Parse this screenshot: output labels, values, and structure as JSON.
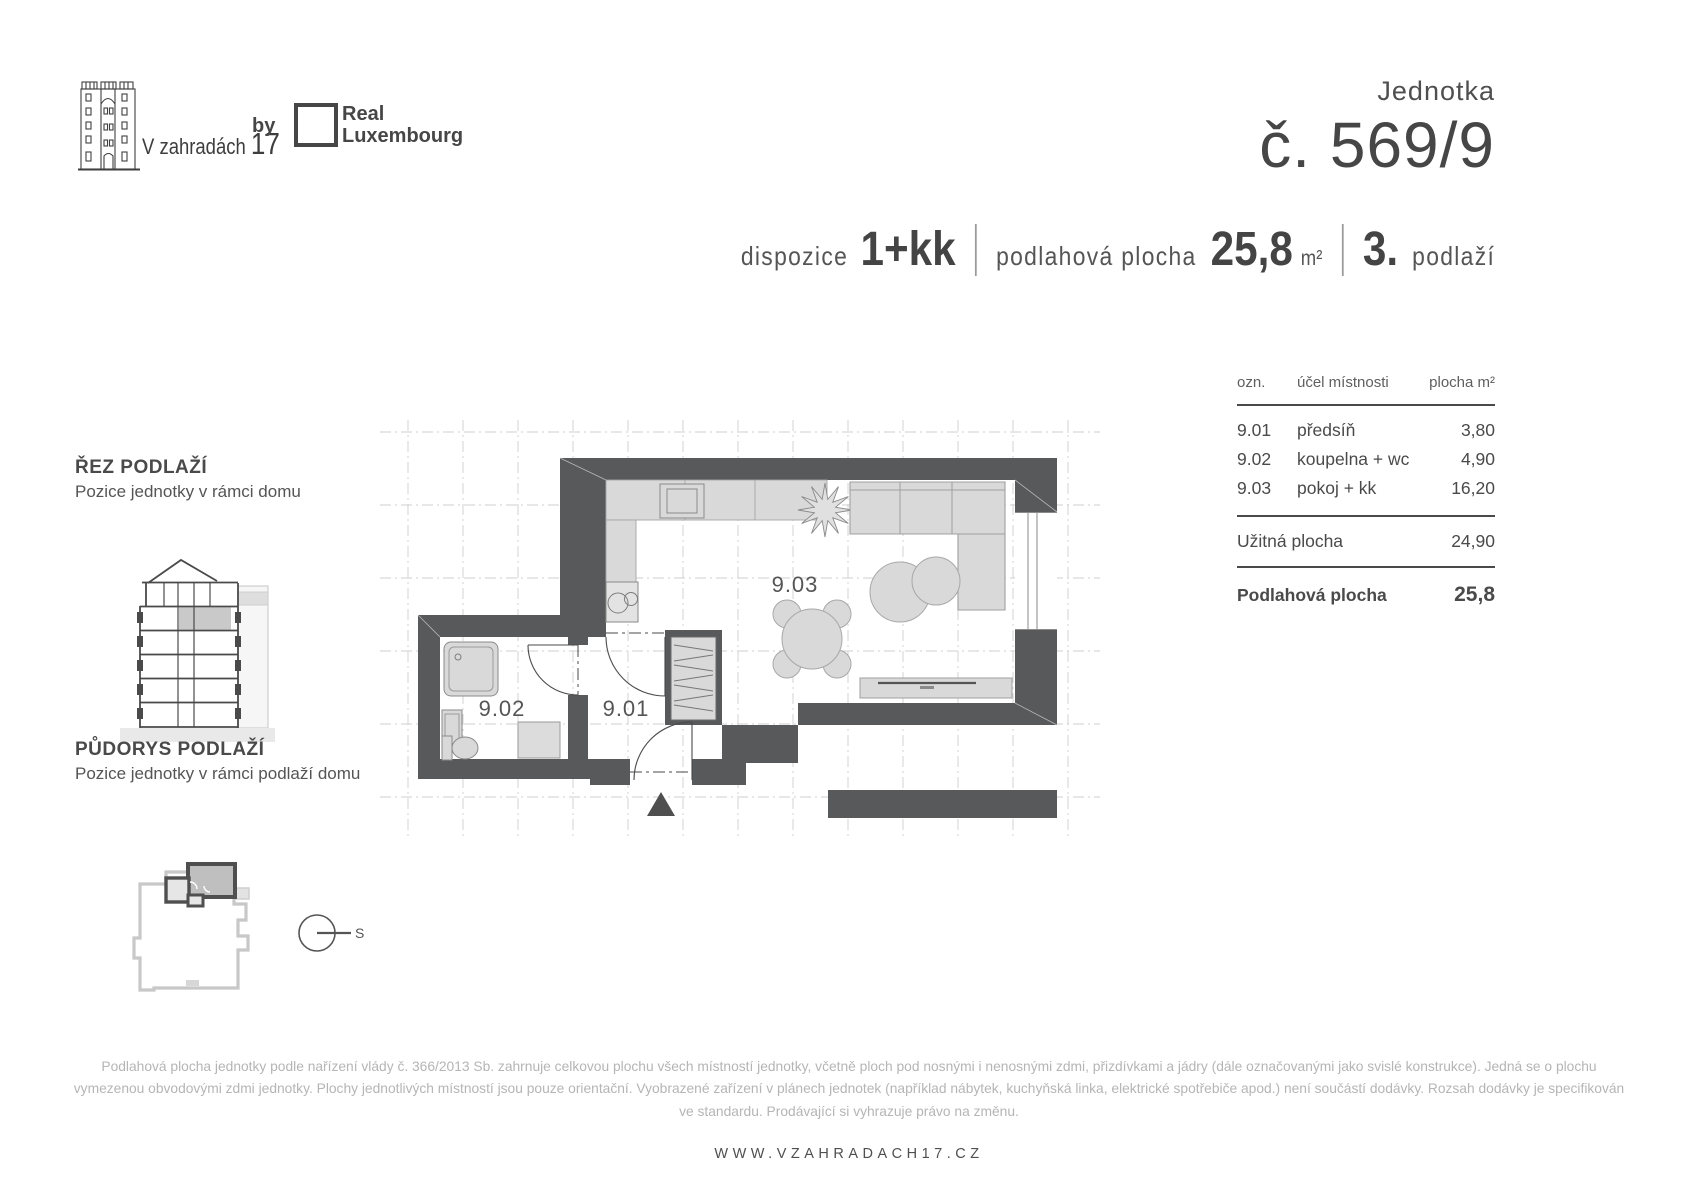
{
  "header": {
    "logo_text": "V zahradách ",
    "logo_number": "17",
    "by_label": "by",
    "brand_line1": "Real",
    "brand_line2": "Luxembourg",
    "unit_label": "Jednotka",
    "unit_number": "č. 569/9"
  },
  "specs": {
    "dispozice_label": "dispozice",
    "dispozice_value": "1+kk",
    "area_label": "podlahová plocha",
    "area_value": "25,8",
    "area_unit": "m²",
    "floor_value": "3.",
    "floor_label": "podlaží"
  },
  "section_cut": {
    "title": "ŘEZ PODLAŽÍ",
    "subtitle": "Pozice jednotky v rámci domu"
  },
  "floor_position": {
    "title": "PŮDORYS PODLAŽÍ",
    "subtitle": "Pozice jednotky v rámci podlaží domu"
  },
  "compass_label": "S",
  "plan": {
    "rooms": [
      {
        "id": "9.01"
      },
      {
        "id": "9.02"
      },
      {
        "id": "9.03"
      }
    ]
  },
  "table": {
    "headers": {
      "ozn": "ozn.",
      "ucel": "účel místnosti",
      "plocha": "plocha m²"
    },
    "rows": [
      {
        "ozn": "9.01",
        "ucel": "předsíň",
        "plocha": "3,80"
      },
      {
        "ozn": "9.02",
        "ucel": "koupelna + wc",
        "plocha": "4,90"
      },
      {
        "ozn": "9.03",
        "ucel": "pokoj + kk",
        "plocha": "16,20"
      }
    ],
    "usable_label": "Užitná plocha",
    "usable_value": "24,90",
    "total_label": "Podlahová plocha",
    "total_value": "25,8"
  },
  "footer": {
    "disclaimer": "Podlahová plocha jednotky podle nařízení vlády č. 366/2013 Sb. zahrnuje celkovou plochu všech místností jednotky, včetně ploch pod nosnými i nenosnými zdmi, přizdívkami a jádry (dále označovanými jako svislé konstrukce). Jedná se o plochu vymezenou obvodovými zdmi jednotky. Plochy jednotlivých místností jsou pouze orientační. Vyobrazené zařízení v plánech jednotek (například nábytek, kuchyňská linka, elektrické spotřebiče apod.) není součástí dodávky. Rozsah dodávky je specifikován ve standardu. Prodávající si vyhrazuje právo na změnu.",
    "website": "WWW.VZAHRADACH17.CZ"
  },
  "colors": {
    "wall": "#58595a",
    "furniture": "#d9d9d9",
    "text": "#4a4a4a"
  }
}
